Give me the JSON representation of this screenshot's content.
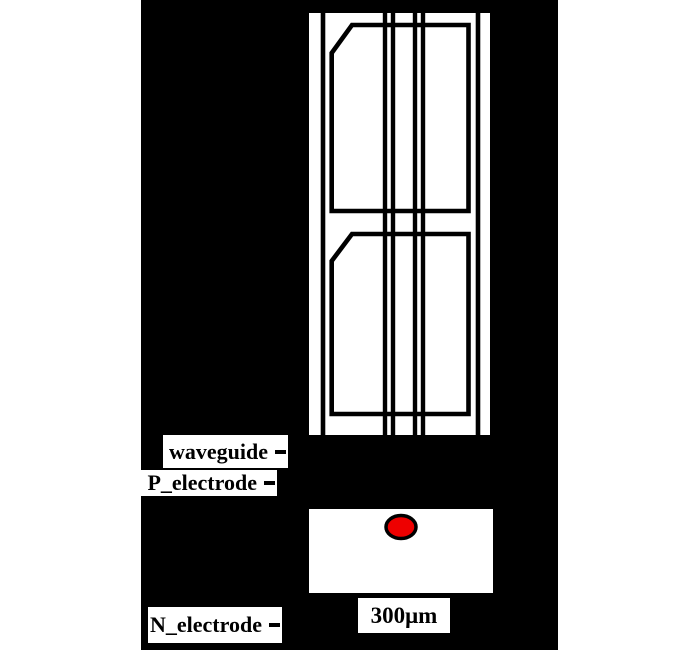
{
  "figure": {
    "description": "laser chip schematic, top view and facet view",
    "labels": {
      "waveguide": "waveguide",
      "p_electrode": "P_electrode",
      "n_electrode": "N_electrode",
      "scale": "300μm"
    },
    "colors": {
      "page_bg": "#ffffff",
      "panel_bg": "#000000",
      "chip_fill": "#ffffff",
      "line": "#000000",
      "spot_fill": "#ee0000",
      "spot_outline": "#000000"
    }
  }
}
